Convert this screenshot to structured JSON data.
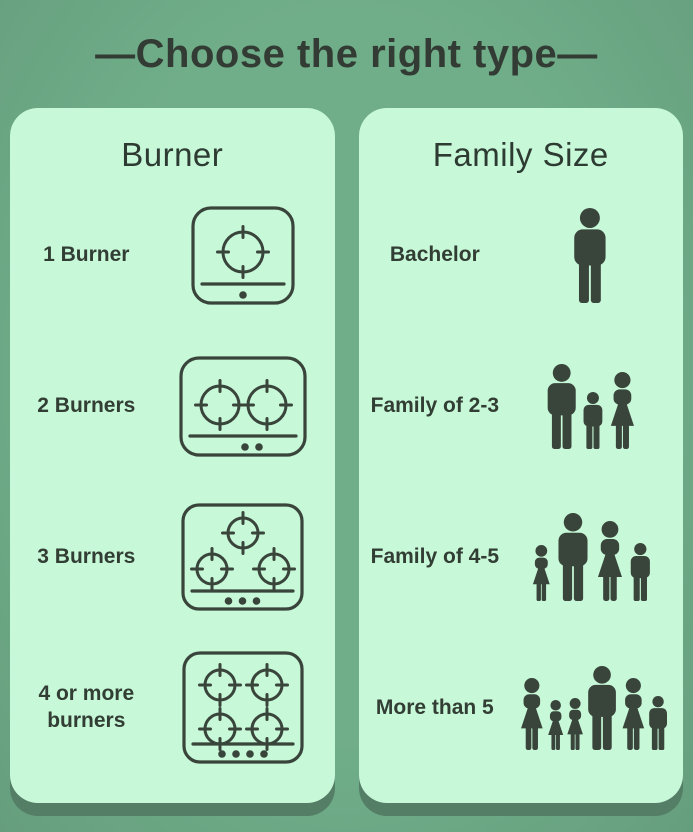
{
  "title": "—Choose the right type—",
  "colors": {
    "background": "#6fad88",
    "panel": "#c7f8d8",
    "panel_shadow": "#547e66",
    "title_text": "#333c34",
    "header_text": "#2d3b32",
    "label_text": "#323e34",
    "icon_color": "#39443b"
  },
  "panels": [
    {
      "id": "burner",
      "header": "Burner",
      "rows": [
        {
          "label": "1 Burner",
          "icon": "stove-1-burner-icon",
          "burners": 1
        },
        {
          "label": "2 Burners",
          "icon": "stove-2-burners-icon",
          "burners": 2
        },
        {
          "label": "3 Burners",
          "icon": "stove-3-burners-icon",
          "burners": 3
        },
        {
          "label": "4 or more burners",
          "icon": "stove-4-burners-icon",
          "burners": 4
        }
      ]
    },
    {
      "id": "family",
      "header": "Family Size",
      "rows": [
        {
          "label": "Bachelor",
          "icon": "bachelor-icon",
          "people": [
            "man"
          ]
        },
        {
          "label": "Family of 2-3",
          "icon": "family-2-3-icon",
          "people": [
            "man",
            "boy",
            "woman"
          ]
        },
        {
          "label": "Family of 4-5",
          "icon": "family-4-5-icon",
          "people": [
            "girl",
            "man",
            "woman",
            "boy"
          ]
        },
        {
          "label": "More than 5",
          "icon": "family-6-icon",
          "people": [
            "woman",
            "girl",
            "girl",
            "man",
            "woman",
            "boy"
          ]
        }
      ]
    }
  ]
}
